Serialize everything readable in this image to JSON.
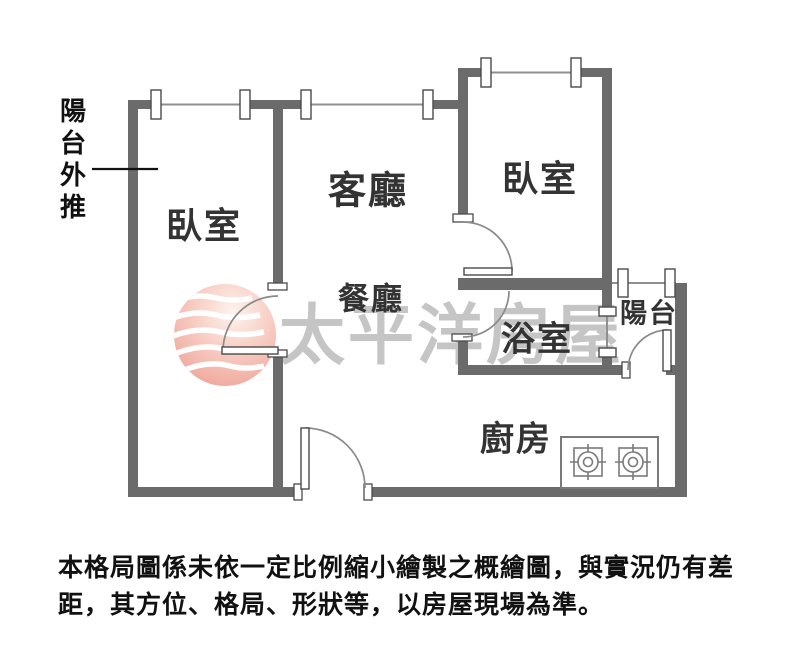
{
  "watermark": {
    "brand_text": "太平洋房屋",
    "logo_icon": "pacific-house-globe-icon",
    "text_color": "#c5c5c5",
    "logo_pink": "#f2ab9f"
  },
  "rooms": {
    "bedroom_left": "臥室",
    "living_room": "客廳",
    "dining_room": "餐廳",
    "bedroom_right": "臥室",
    "bathroom": "浴室",
    "balcony": "陽台",
    "kitchen": "廚房"
  },
  "annotations": {
    "balcony_pushed_out": "陽台外推"
  },
  "disclaimer": {
    "line1": "本格局圖係未依一定比例縮小繪製之概繪圖，與實況仍有差",
    "line2": "距，其方位、格局、形狀等，以房屋現場為準。"
  },
  "colors": {
    "wall": "#6b6b6b",
    "thin_line": "#8f8f8f",
    "label_text": "#333333",
    "note_text": "#111111",
    "background": "#ffffff"
  }
}
